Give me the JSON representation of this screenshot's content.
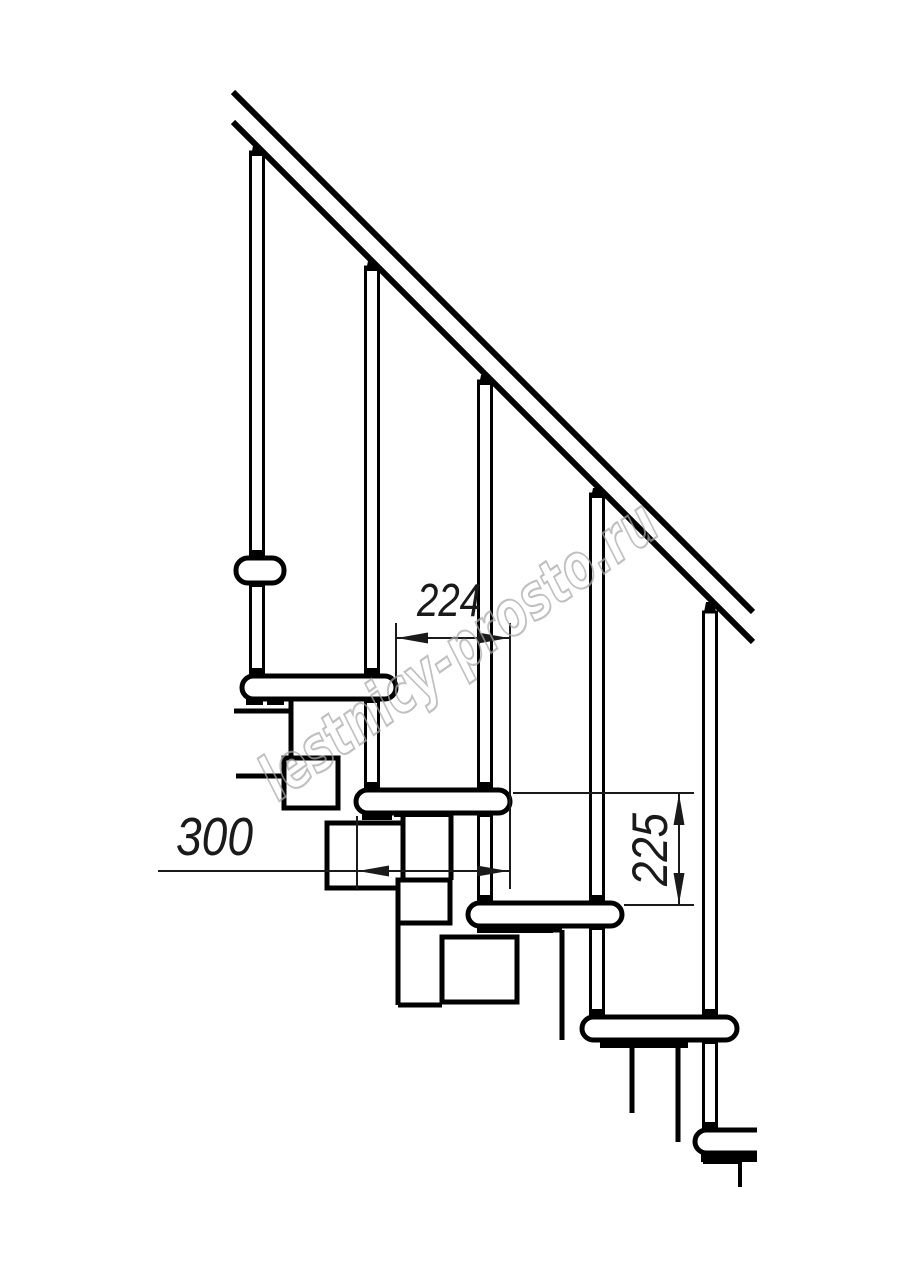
{
  "page": {
    "background": "#ffffff"
  },
  "drawing": {
    "watermark": {
      "text": "lestnicy-prosto.ru",
      "color": "#a8a8a8"
    },
    "dimensions": [
      {
        "id": "run-between-noses",
        "label": "224",
        "orientation": "horizontal"
      },
      {
        "id": "tread-depth",
        "label": "300",
        "orientation": "horizontal"
      },
      {
        "id": "riser-height",
        "label": "225",
        "orientation": "vertical"
      }
    ],
    "colors": {
      "line": "#000000",
      "dimension_text": "#1a1a1a",
      "background": "#ffffff"
    }
  }
}
